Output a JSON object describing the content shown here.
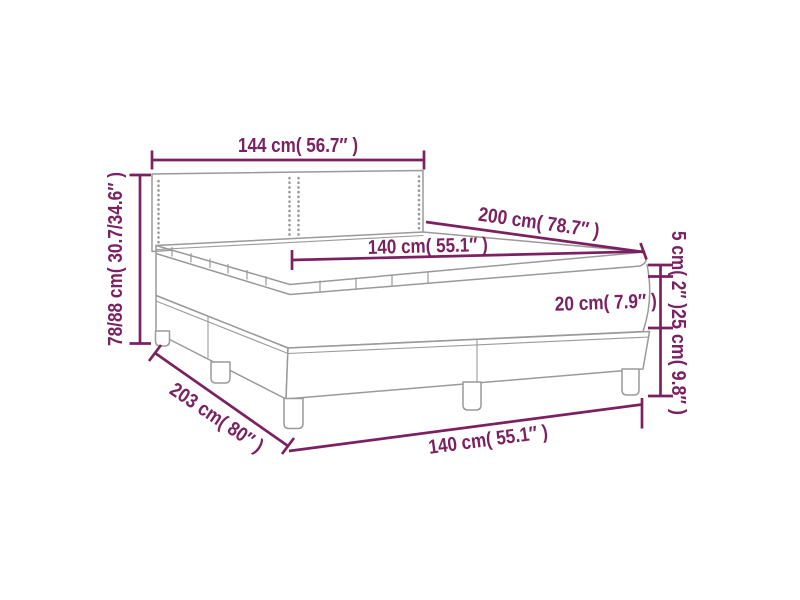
{
  "diagram": {
    "type": "product-dimension-diagram",
    "subject": "box spring bed with headboard, mattress topper, mattress and two-piece base on legs",
    "colors": {
      "dimension_accent": "#7b2161",
      "drawing_line": "#9a9a9a",
      "background": "#ffffff"
    },
    "labels": {
      "headboard_width": "144 cm( 56.7″ )",
      "headboard_height": "78/88 cm( 30.7/34.6″ )",
      "bed_length": "200 cm( 78.7″ )",
      "mattress_width": "140 cm( 55.1″ )",
      "topper_thickness": "5 cm( 2″ )",
      "mattress_thickness": "20 cm( 7.9″ )",
      "base_height": "25 cm( 9.8″ )",
      "total_length": "203 cm( 80″ )",
      "base_width": "140 cm( 55.1″ )"
    }
  }
}
